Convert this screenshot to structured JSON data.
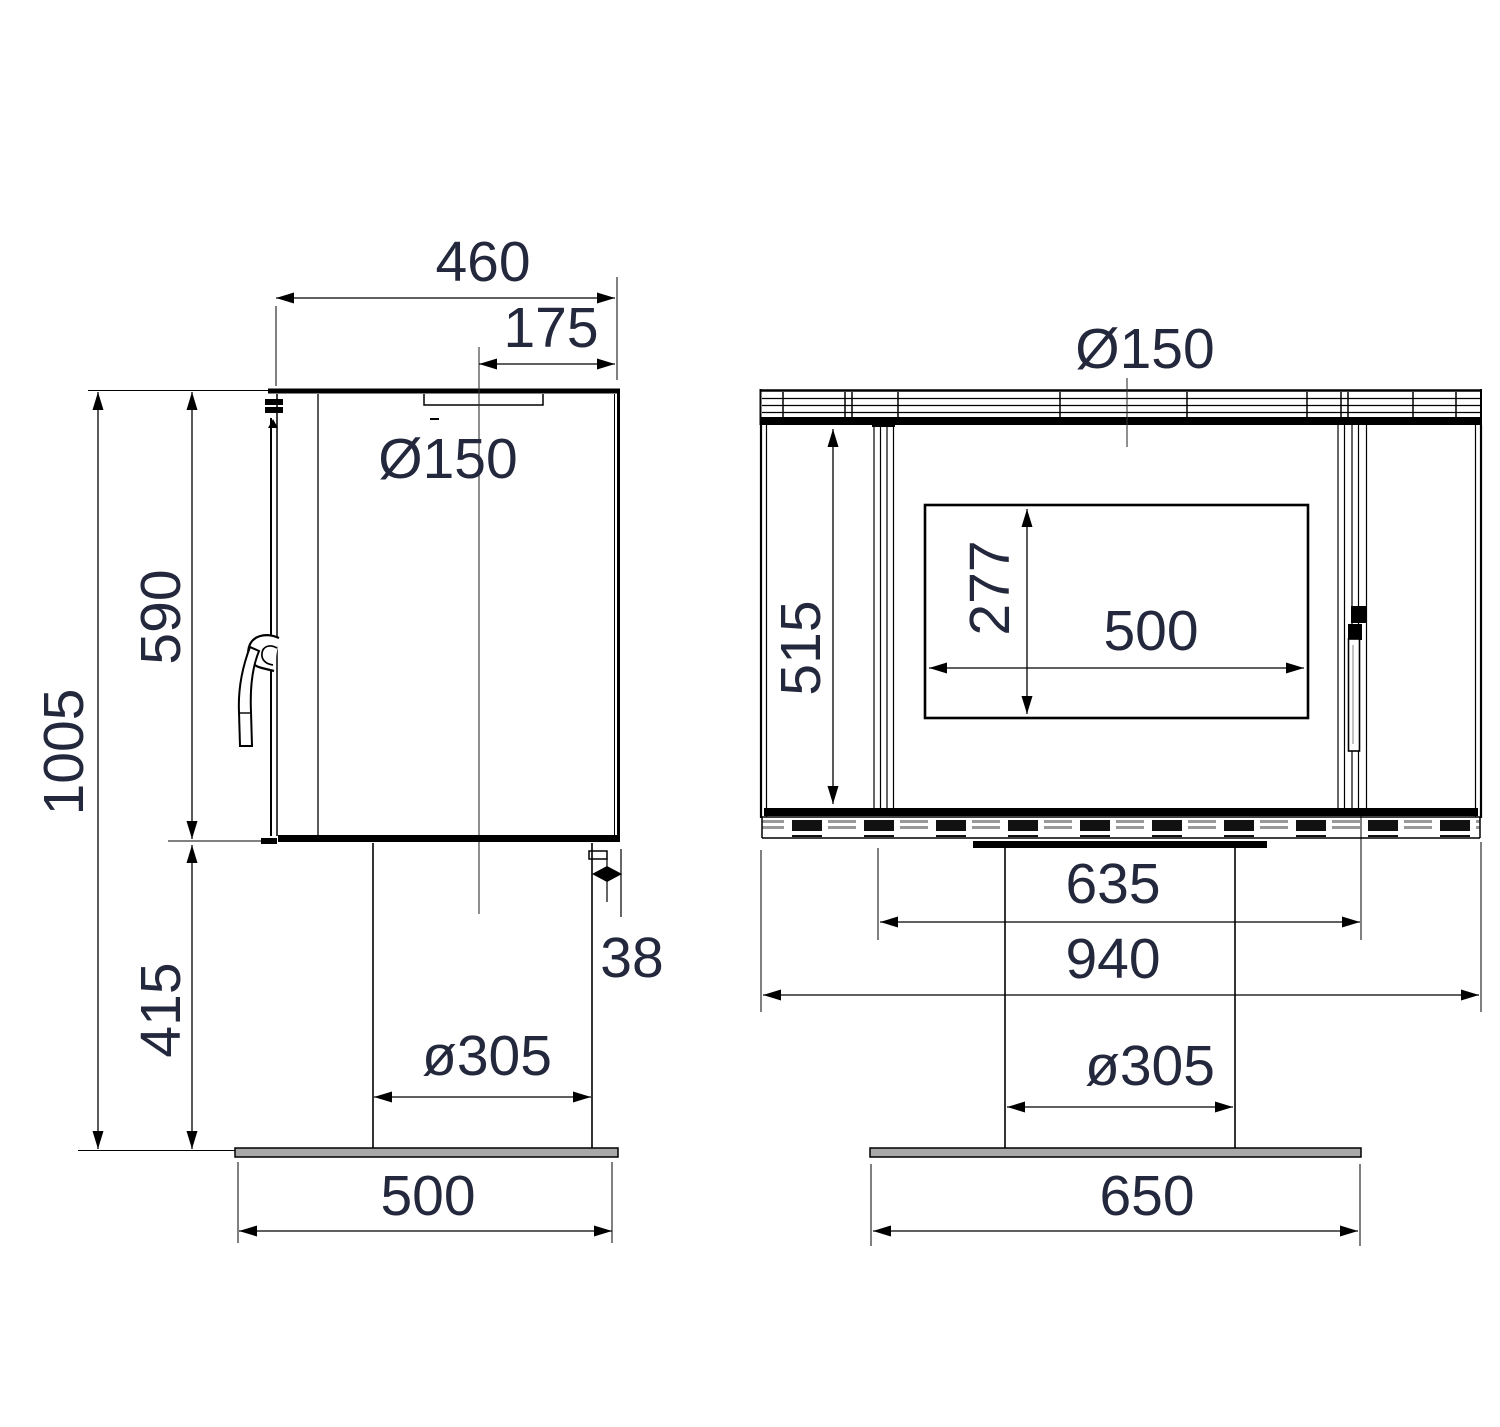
{
  "meta": {
    "title": "Stove technical dimension drawing",
    "background_color": "#ffffff",
    "line_color": "#000000",
    "text_color": "#23283c"
  },
  "side_view": {
    "name": "side-view",
    "dims": {
      "total_height": "1005",
      "body_height": "590",
      "pedestal_height": "415",
      "width": "460",
      "flue_offset": "175",
      "flue_diameter": "Ø150",
      "rear_gap": "38",
      "pedestal_diameter": "ø305",
      "base_width": "500"
    }
  },
  "front_view": {
    "name": "front-view",
    "dims": {
      "flue_diameter": "Ø150",
      "firebox_height": "515",
      "glass_height": "277",
      "glass_width": "500",
      "inner_width": "635",
      "body_width": "940",
      "pedestal_diameter": "ø305",
      "base_width": "650"
    }
  }
}
